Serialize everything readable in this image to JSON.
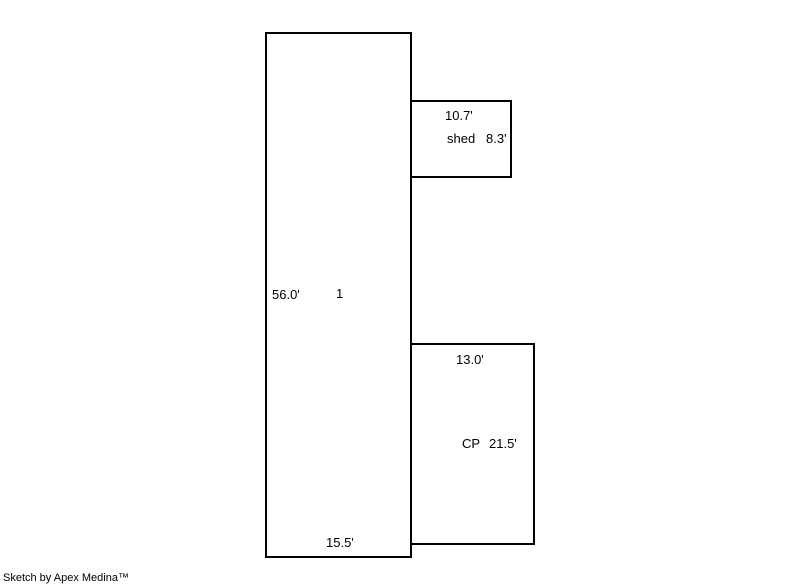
{
  "colors": {
    "background": "#ffffff",
    "line": "#000000",
    "text": "#000000"
  },
  "areas": {
    "main": {
      "id_label": "1",
      "height_dim": "56.0'",
      "width_dim": "15.5'"
    },
    "shed": {
      "label": "shed",
      "width_dim": "10.7'",
      "height_dim": "8.3'"
    },
    "carport": {
      "label": "CP",
      "width_dim": "13.0'",
      "height_dim": "21.5'"
    }
  },
  "footer": {
    "credit": "Sketch by Apex Medina™"
  }
}
